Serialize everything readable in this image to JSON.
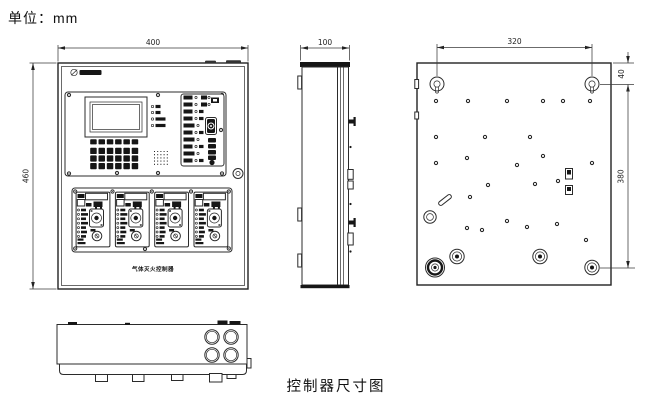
{
  "page": {
    "unit_label": "单位：mm",
    "caption": "控制器尺寸图"
  },
  "dimensions": {
    "front_width": "400",
    "front_height": "460",
    "side_depth": "100",
    "back_mount_span": "320",
    "back_mount_top_offset": "40",
    "back_mount_height": "380"
  },
  "front_panel": {
    "device_label": "气体灭火控制器"
  },
  "colors": {
    "line": "#2b2b2b",
    "background": "#ffffff",
    "ink": "#161616"
  },
  "icons": {
    "logo": "brand-logo-icon",
    "lock": "panel-lock-icon",
    "keyswitch": "keyswitch-icon",
    "speaker": "speaker-grille-icon",
    "screw": "screw-icon"
  }
}
